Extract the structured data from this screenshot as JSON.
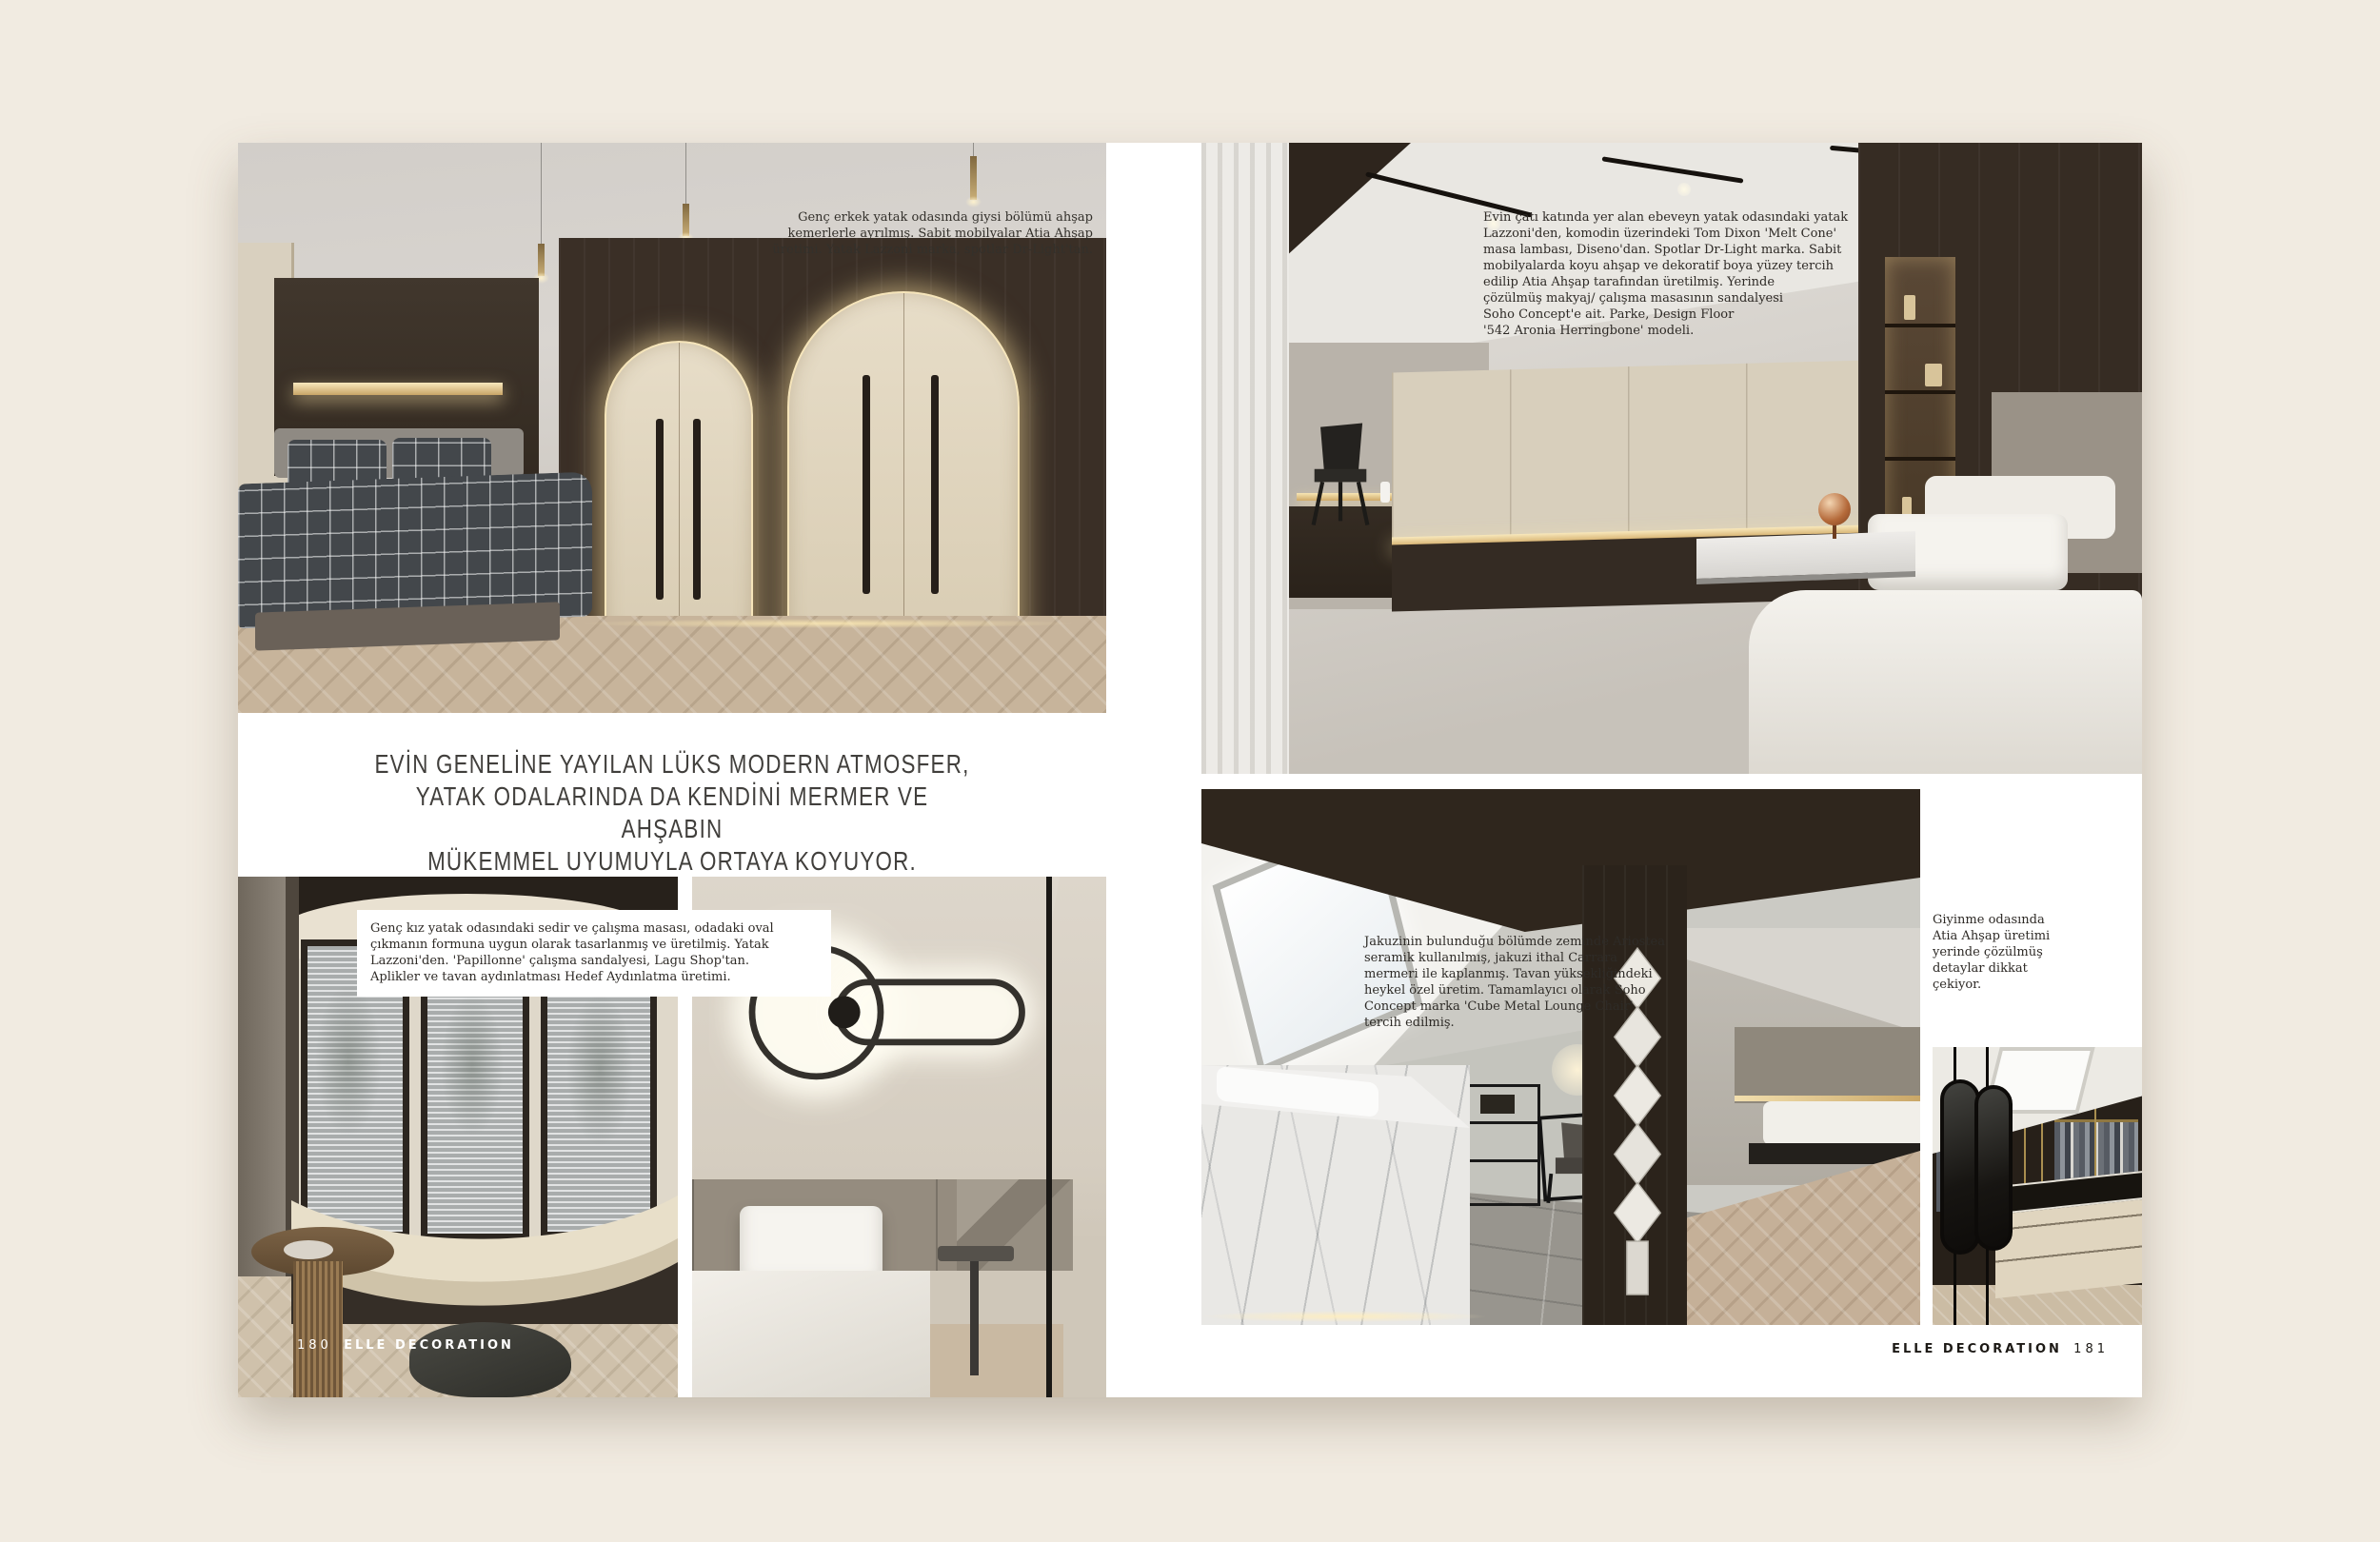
{
  "headline": {
    "text": "EVİN GENELİNE YAYILAN LÜKS MODERN ATMOSFER,\nYATAK ODALARINDA DA KENDİNİ MERMER VE AHŞABIN\nMÜKEMMEL UYUMUYLA ORTAYA KOYUYOR."
  },
  "captions": {
    "boys_room": "Genç erkek yatak odasında giysi bölümü ahşap\nkemerlerle ayrılmış. Sabit mobilyalar Atia Ahşap\nüretimi. Yatak Lazzoni marka, spotlar Dr-Light'tan.",
    "master_bedroom": "Evin çatı katında yer alan ebeveyn yatak odasındaki yatak\nLazzoni'den, komodin üzerindeki Tom Dixon 'Melt Cone'\nmasa lambası, Diseno'dan. Spotlar Dr-Light marka. Sabit\nmobilyalarda koyu ahşap ve dekoratif boya yüzey tercih\nedilip Atia Ahşap tarafından üretilmiş. Yerinde\nçözülmüş makyaj/ çalışma masasının sandalyesi\nSoho Concept'e ait. Parke, Design Floor\n'542 Aronia Herringbone' modeli.",
    "girls_room": "Genç kız yatak odasındaki sedir ve çalışma masası, odadaki oval\nçıkmanın formuna uygun olarak tasarlanmış ve üretilmiş. Yatak\nLazzoni'den. 'Papillonne' çalışma sandalyesi, Lagu Shop'tan.\nAplikler ve tavan aydınlatması Hedef Aydınlatma üretimi.",
    "jacuzzi": "Jakuzinin bulunduğu bölümde zeminde Ariostea\nseramik kullanılmış, jakuzi ithal Carrara\nmermeri ile kaplanmış. Tavan yüksekliğindeki\nheykel özel üretim. Tamamlayıcı olarak Soho\nConcept marka 'Cube Metal Lounge Chair'\ntercih edilmiş.",
    "dressing_room": "Giyinme odasında\nAtia Ahşap üretimi\nyerinde çözülmüş\ndetaylar dikkat\nçekiyor."
  },
  "footer": {
    "left_page_number": "180",
    "right_page_number": "181",
    "brand": "ELLE DECORATION"
  },
  "colors": {
    "background": "#f1ebe1",
    "paper": "#ffffff",
    "headline_text": "#413f3c",
    "caption_text": "#2e2a26",
    "dark_wood": "#352b22",
    "cream_cabinet": "#d8cfbc",
    "warm_glow": "#f4e3b4",
    "marble": "#e9e8e5",
    "copper_lamp": "#b56a3a",
    "footer_light": "#ffffff",
    "footer_dark": "#1c1915"
  }
}
